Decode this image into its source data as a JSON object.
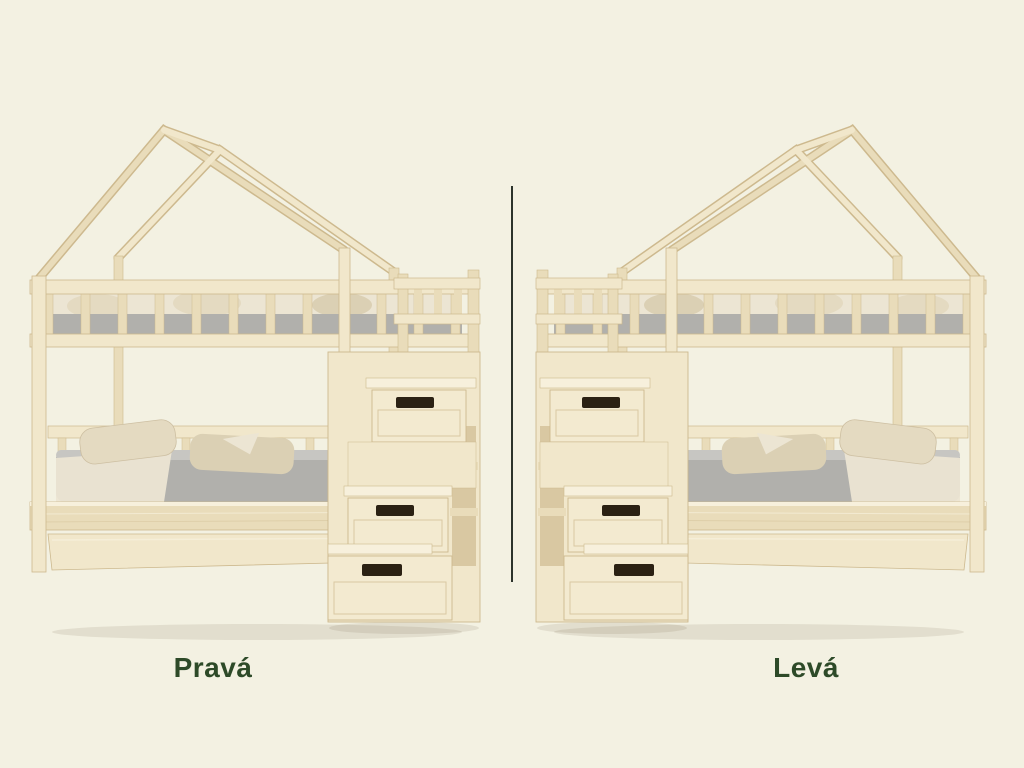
{
  "image": {
    "kind": "product-variant-comparison",
    "subject": "house-shaped bunk bed with storage staircase and under-bed drawer"
  },
  "variants": [
    {
      "label": "Pravá",
      "staircase_side": "right"
    },
    {
      "label": "Levá",
      "staircase_side": "left"
    }
  ],
  "colors": {
    "bg": "#f3f1e2",
    "divider": "#2c332b",
    "label": "#2d4a28",
    "wood_light": "#f1e7cb",
    "wood_mid": "#e9dcba",
    "wood_dark": "#cdb98e",
    "wood_deep": "#d9c8a2",
    "wood_hi": "#f7f0dc",
    "drawer": "#f3ead0",
    "handle": "#2b2113",
    "mattress": "#b1b0ac",
    "mattress_hi": "#c7c6c2",
    "sheet": "#ece5d3",
    "pillow": "#e4dac1",
    "pillow_dk": "#dbd0b4",
    "shadow": "rgba(74,62,31,0.10)"
  }
}
